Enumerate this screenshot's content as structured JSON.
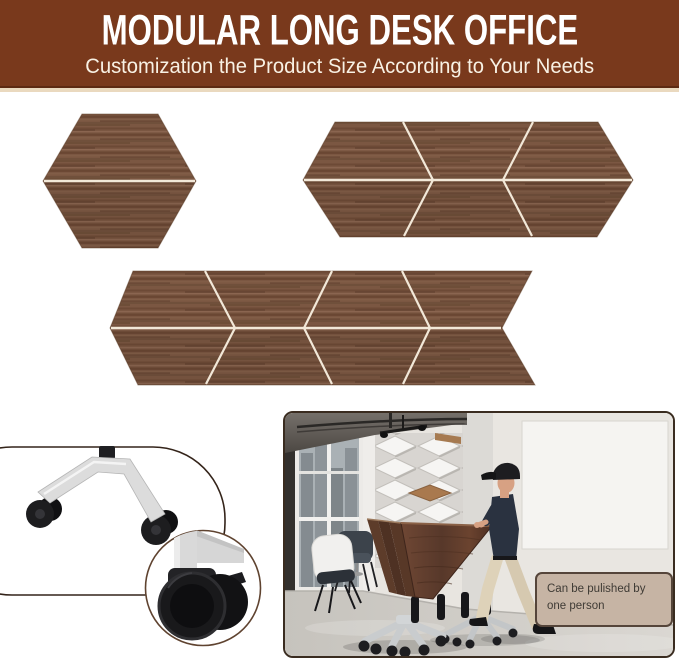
{
  "page": {
    "type": "product-infographic",
    "background": "#ffffff"
  },
  "banner": {
    "title": "MODULAR LONG DESK OFFICE",
    "subtitle": "Customization the Product Size According to Your Needs",
    "background_color": "#79391c",
    "title_color": "#ffffff",
    "subtitle_color": "#f8f1e4"
  },
  "desk_shapes": {
    "wood_color": "#7b5742",
    "seam_color": "#f2e8d8",
    "configurations": [
      {
        "name": "hexagon desk",
        "modules": 2
      },
      {
        "name": "long conference desk",
        "modules": 6
      },
      {
        "name": "extra long conference desk",
        "modules": 8
      }
    ]
  },
  "caster_detail": {
    "leg_color": "#dcdcdc",
    "wheel_color": "#1b1b1d",
    "feature": "dual-wheel locking caster"
  },
  "office_photo": {
    "caption": "Can be pulished by one person",
    "caption_background": "#c6b4a4",
    "caption_border": "#55453a",
    "caption_text_color": "#3f3b35"
  }
}
